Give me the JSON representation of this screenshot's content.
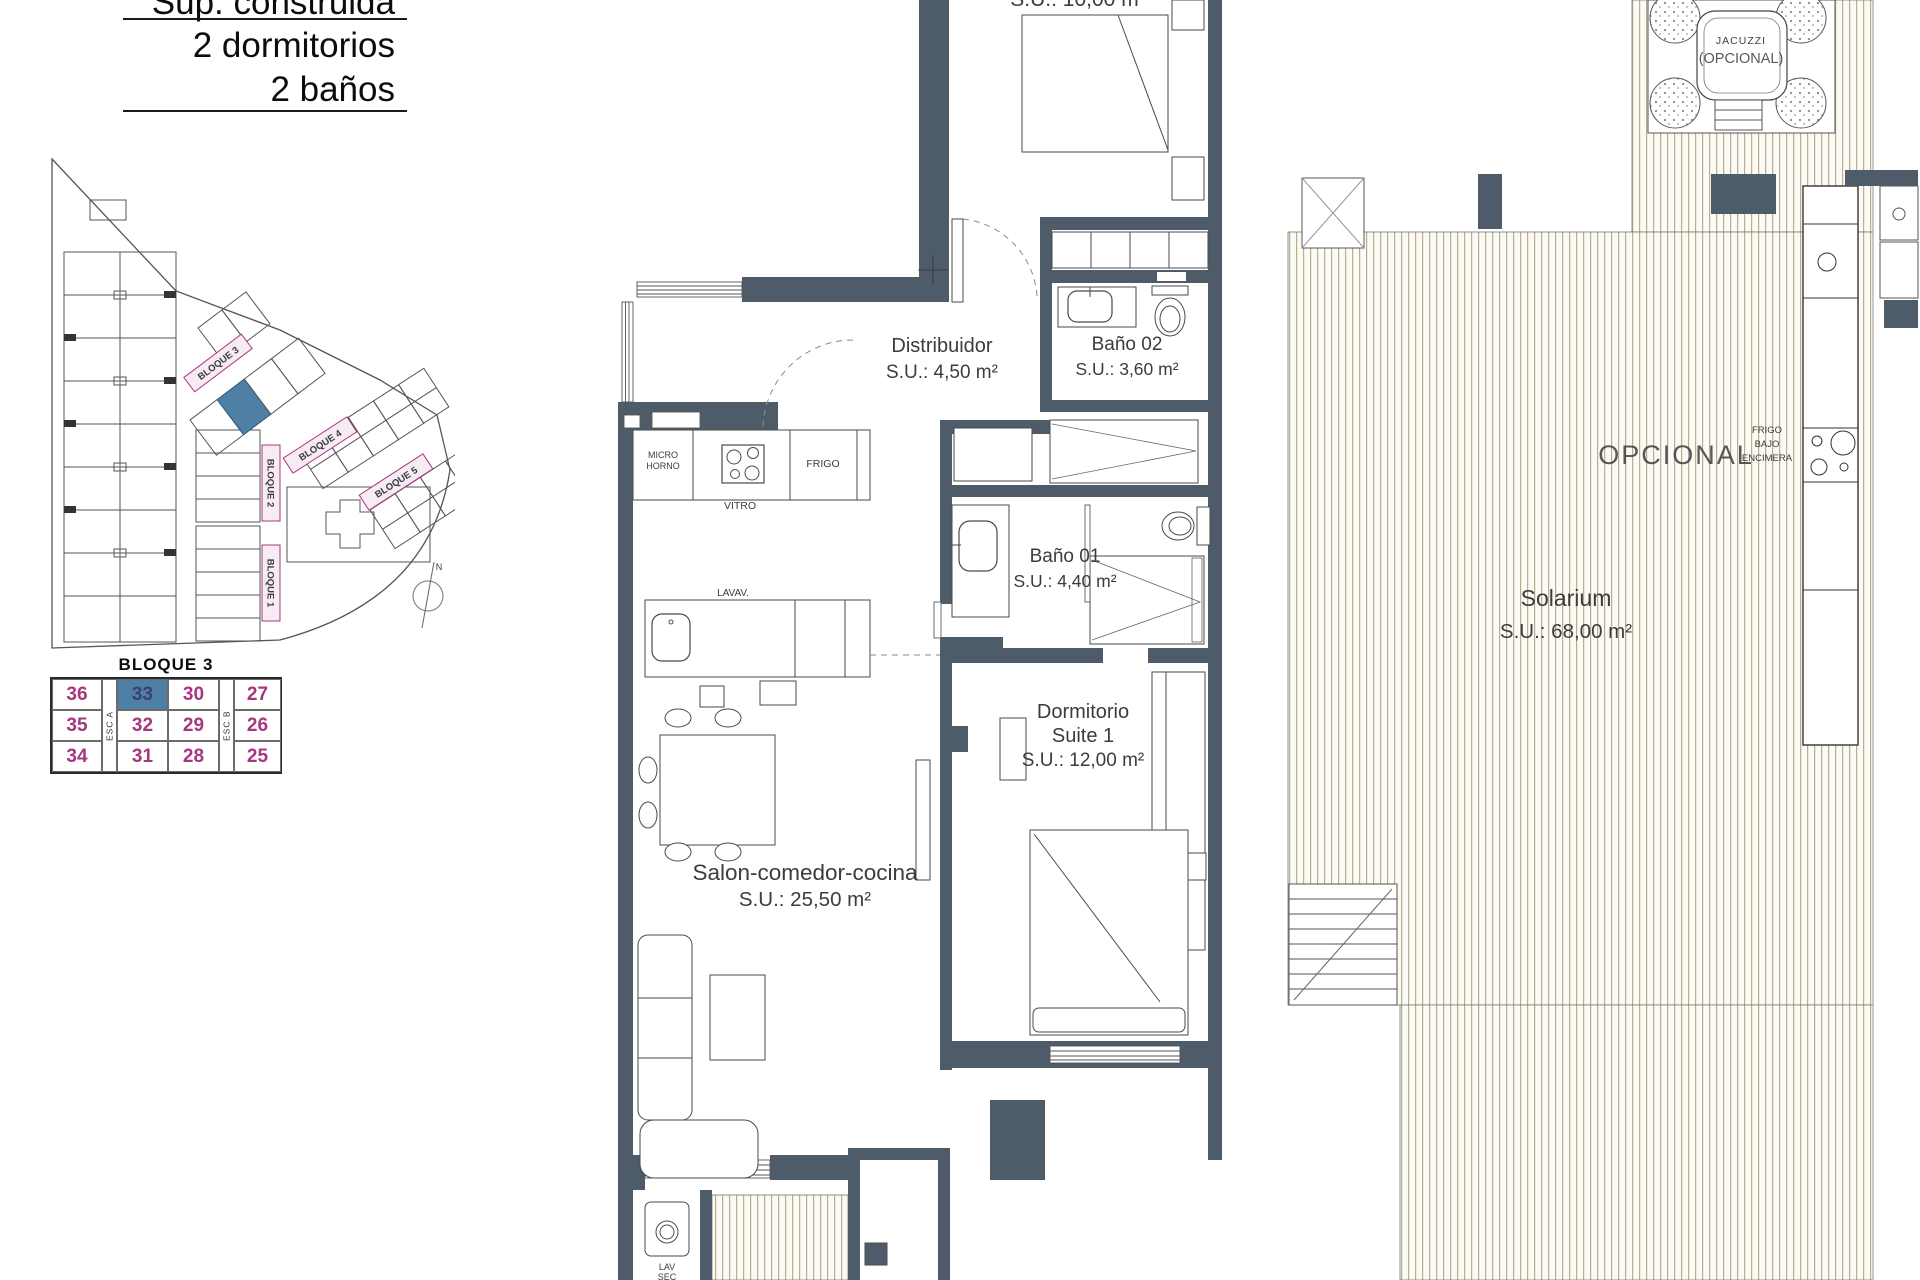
{
  "header": {
    "title_clipped": "Sup. construida",
    "bedrooms": "2 dormitorios",
    "bathrooms": "2 baños"
  },
  "site_plan": {
    "blocks": {
      "b1": "BLOQUE 1",
      "b2": "BLOQUE 2",
      "b3": "BLOQUE 3",
      "b4": "BLOQUE 4",
      "b5": "BLOQUE 5"
    },
    "compass": "N"
  },
  "unit_table": {
    "title": "BLOQUE 3",
    "stair_a": "ESC A",
    "stair_b": "ESC B",
    "rows": [
      [
        "36",
        "33",
        "30",
        "27"
      ],
      [
        "35",
        "32",
        "29",
        "26"
      ],
      [
        "34",
        "31",
        "28",
        "25"
      ]
    ],
    "highlighted_unit": "33"
  },
  "rooms": {
    "bedroom2": {
      "area": "S.U.: 10,00 m²"
    },
    "distribuidor": {
      "name": "Distribuidor",
      "area": "S.U.: 4,50 m²"
    },
    "bano02": {
      "name": "Baño 02",
      "area": "S.U.: 3,60 m²"
    },
    "bano01": {
      "name": "Baño 01",
      "area": "S.U.: 4,40 m²"
    },
    "suite": {
      "line1": "Dormitorio",
      "line2": "Suite 1",
      "area": "S.U.: 12,00 m²"
    },
    "salon": {
      "name": "Salon-comedor-cocina",
      "area": "S.U.: 25,50 m²"
    },
    "solarium": {
      "name": "Solarium",
      "area": "S.U.: 68,00 m²"
    }
  },
  "kitchen": {
    "micro1": "MICRO",
    "micro2": "HORNO",
    "vitro": "VITRO",
    "frigo": "FRIGO",
    "lavav": "LAVAV."
  },
  "laundry": {
    "lav": "LAV",
    "sec": "SEC"
  },
  "solarium_features": {
    "jacuzzi": "JACUZZI",
    "jacuzzi_note": "(OPCIONAL)",
    "opcional": "OPCIONAL",
    "frigo1": "FRIGO",
    "frigo2": "BAJO",
    "frigo3": "ENCIMERA"
  },
  "colors": {
    "wall": "#4e5c6a",
    "magenta": "#a8357f",
    "highlight_blue": "#4e80a6",
    "accent_red": "#c0504d",
    "deck_line": "#b9ae90"
  }
}
